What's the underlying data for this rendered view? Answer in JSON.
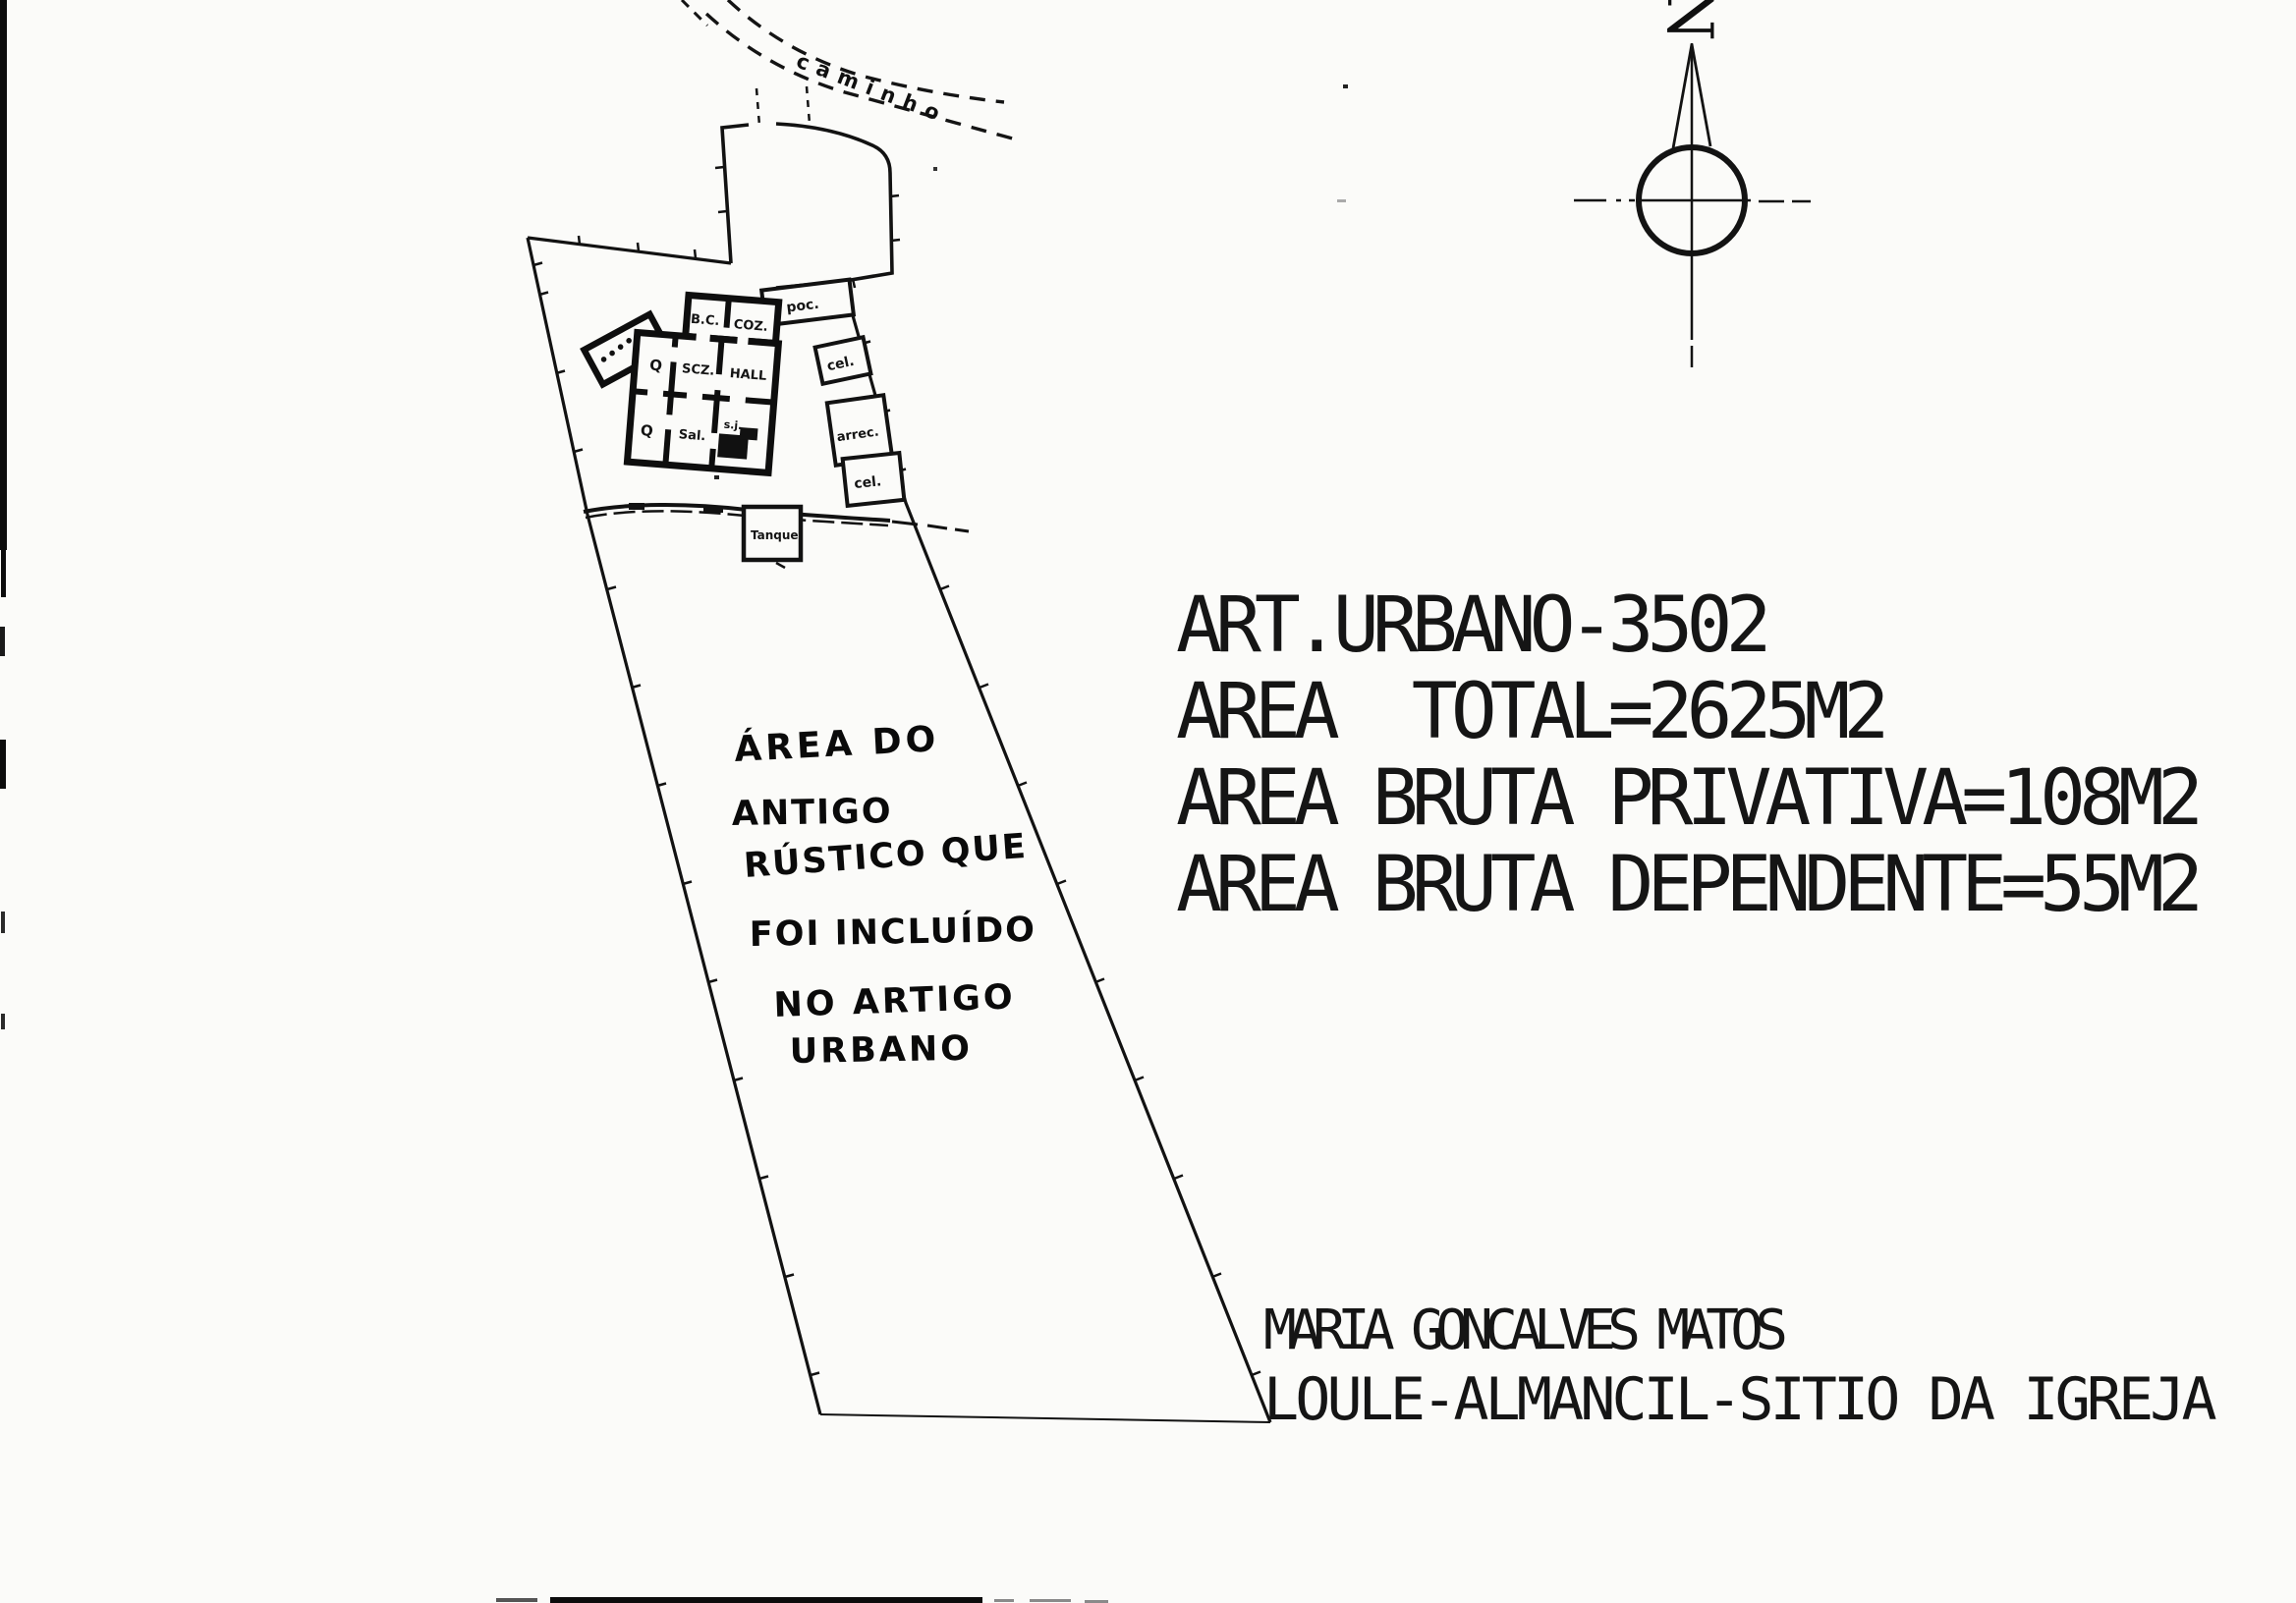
{
  "north_indicator": {
    "label": "N"
  },
  "road": {
    "label": "caminho"
  },
  "site_plan": {
    "outbuildings": [
      "poc.",
      "cel.",
      "arrec.",
      "cel."
    ],
    "tank_label": "Tanque",
    "house_rooms": {
      "top": [
        "B.C.",
        "COZ."
      ],
      "middle": [
        "Q",
        "SCZ.",
        "HALL"
      ],
      "bottom": [
        "Q",
        "Sal.",
        "s.j."
      ]
    }
  },
  "handwritten_note": {
    "lines": [
      "ÁREA DO",
      "ANTIGO",
      "RÚSTICO QUE",
      "FOI INCLUÍDO",
      "NO ARTIGO",
      "URBANO"
    ]
  },
  "property_info": {
    "lines": [
      "ART.URBANO-3502",
      "AREA  TOTAL=2625M2",
      "AREA BRUTA PRIVATIVA=108M2",
      "AREA BRUTA DEPENDENTE=55M2"
    ]
  },
  "owner_info": {
    "name": "MARIA GONCALVES MATOS",
    "location": "LOULE-ALMANCIL-SITIO DA IGREJA"
  }
}
